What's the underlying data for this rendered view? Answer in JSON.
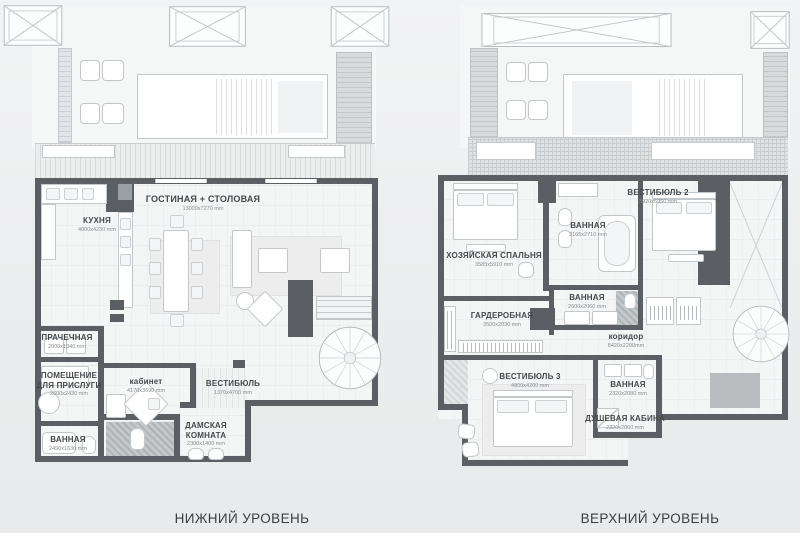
{
  "captions": {
    "lower": "НИЖНИЙ УРОВЕНЬ",
    "upper": "ВЕРХНИЙ УРОВЕНЬ"
  },
  "colors": {
    "wall": "#5b5f63",
    "floor": "#f4f5f5",
    "background": "#ecedee",
    "label_text": "#45484b",
    "dims_text": "#898d90"
  },
  "lower_level": {
    "rooms": [
      {
        "id": "kitchen",
        "name": "КУХНЯ",
        "dims": "4000x4230 mm"
      },
      {
        "id": "living_dining",
        "name": "ГОСТИНАЯ + СТОЛОВАЯ",
        "dims": "13000x7270 mm"
      },
      {
        "id": "laundry",
        "name": "ПРАЧЕЧНАЯ",
        "dims": "2000x1340 mm"
      },
      {
        "id": "maid_room",
        "name": "ПОМЕЩЕНИЕ\nДЛЯ ПРИСЛУГИ",
        "dims": "2600x2430 mm"
      },
      {
        "id": "bathroom",
        "name": "ВАННАЯ",
        "dims": "2490x1630 mm"
      },
      {
        "id": "office",
        "name": "кабинет",
        "dims": "4170x3690 mm"
      },
      {
        "id": "vestibule",
        "name": "ВЕСТИБЮЛЬ",
        "dims": "1370x4700 mm"
      },
      {
        "id": "ladies_room",
        "name": "ДАМСКАЯ\nКОМНАТА",
        "dims": "2300x1400 mm"
      }
    ]
  },
  "upper_level": {
    "rooms": [
      {
        "id": "vestibule_2",
        "name": "ВЕСТИБЮЛЬ 2",
        "dims": "3920x5950 mm"
      },
      {
        "id": "bathroom_1",
        "name": "ВАННАЯ",
        "dims": "3165x2710 mm"
      },
      {
        "id": "master_bedroom",
        "name": "ХОЗЯЙСКАЯ СПАЛЬНЯ",
        "dims": "3585x5910 mm"
      },
      {
        "id": "bathroom_2",
        "name": "ВАННАЯ",
        "dims": "2600x2060 mm"
      },
      {
        "id": "wardrobe",
        "name": "ГАРДЕРОБНАЯ",
        "dims": "3500x2030 mm"
      },
      {
        "id": "corridor",
        "name": "коридор",
        "dims": "8420x2200mm"
      },
      {
        "id": "vestibule_3",
        "name": "ВЕСТИБЮЛЬ 3",
        "dims": "4800x4200 mm"
      },
      {
        "id": "bathroom_3",
        "name": "ВАННАЯ",
        "dims": "2320x2080 mm"
      },
      {
        "id": "shower_cabin",
        "name": "ДУШЕВАЯ КАБИНА",
        "dims": "2320x2060 mm"
      }
    ]
  }
}
